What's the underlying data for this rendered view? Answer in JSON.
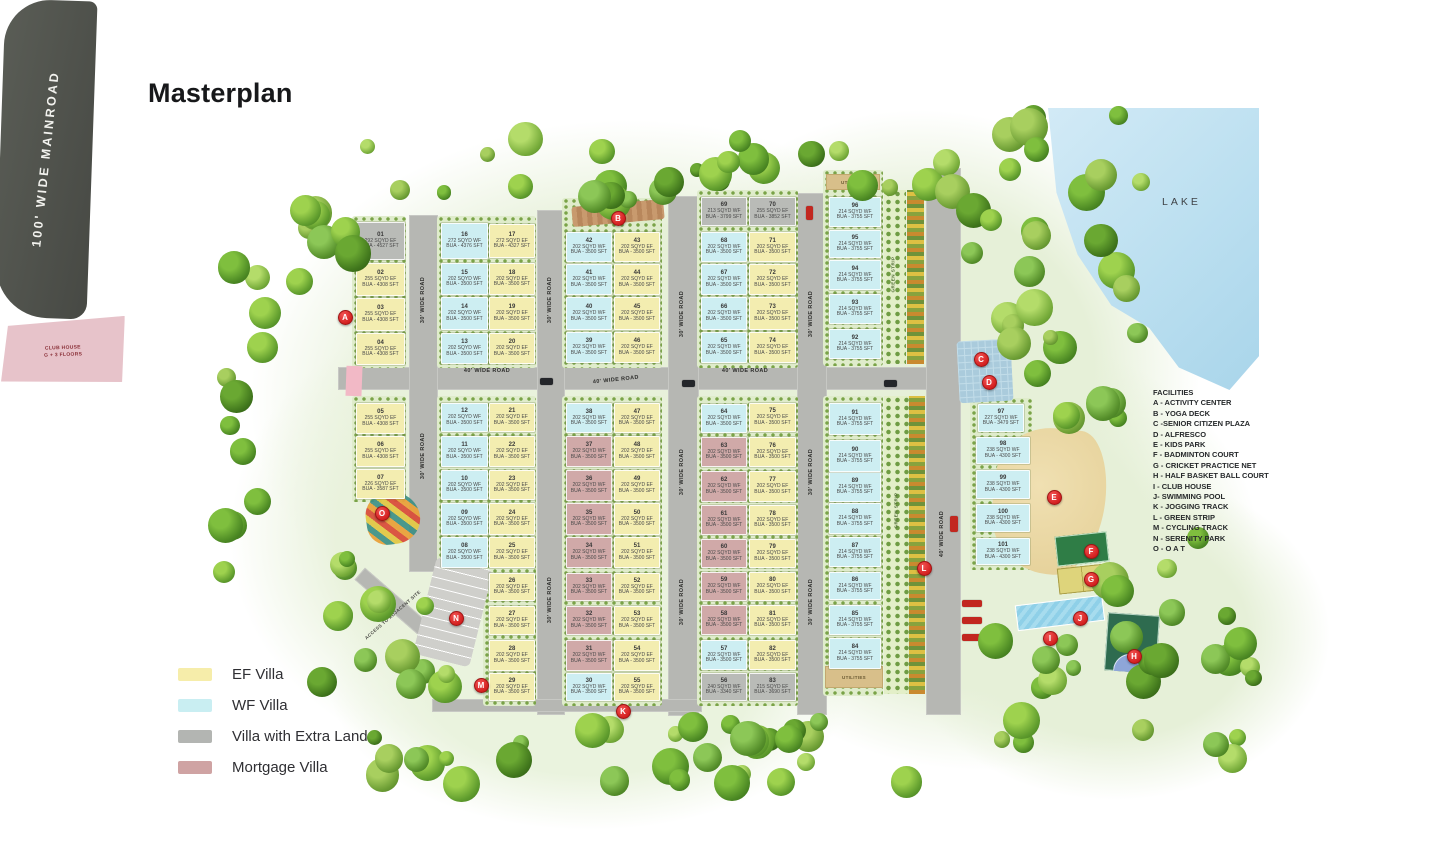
{
  "page": {
    "title": "Masterplan"
  },
  "legend": {
    "items": [
      {
        "label": "EF Villa",
        "color": "#f6edaa"
      },
      {
        "label": "WF Villa",
        "color": "#c9eef2"
      },
      {
        "label": "Villa with Extra Land",
        "color": "#b3b5b2"
      },
      {
        "label": "Mortgage Villa",
        "color": "#cfa3a3"
      }
    ]
  },
  "facilities": {
    "title": "FACILITIES",
    "items": [
      "A - ACTIVITY CENTER",
      "B - YOGA DECK",
      "C -SENIOR CITIZEN PLAZA",
      "D - ALFRESCO",
      "E - KIDS PARK",
      "F - BADMINTON COURT",
      "G - CRICKET PRACTICE NET",
      "H - HALF BASKET BALL COURT",
      "I - CLUB HOUSE",
      "J- SWIMMING POOL",
      "K - JOGGING TRACK",
      "L - GREEN STRIP",
      "M - CYCLING TRACK",
      "N - SERENITY PARK",
      "O - O A T"
    ]
  },
  "map": {
    "lake_label": "LAKE",
    "mainroad_label": "100' WIDE MAINROAD",
    "access_label": "ACCESS TO ADJACENT SITE",
    "utilities_label": "UTILITIES",
    "green_strip_label": "GREEN STRIP",
    "clubhouse": {
      "line1": "CLUB HOUSE",
      "line2": "G + 3 FLOORS"
    },
    "formats": {
      "spec": "{sq} SQYD {f}",
      "bua": "BUA - {bua} SFT"
    },
    "road_labels": [
      {
        "text": "40' WIDE ROAD",
        "x": 452,
        "y": 368,
        "r": 0
      },
      {
        "text": "40' WIDE ROAD",
        "x": 581,
        "y": 377,
        "r": -6
      },
      {
        "text": "40' WIDE ROAD",
        "x": 710,
        "y": 368,
        "r": 0
      },
      {
        "text": "40' WIDE ROAD",
        "x": 908,
        "y": 530,
        "r": -90
      },
      {
        "text": "30' WIDE ROAD",
        "x": 389,
        "y": 296,
        "r": -90
      },
      {
        "text": "30' WIDE ROAD",
        "x": 389,
        "y": 452,
        "r": -90
      },
      {
        "text": "30' WIDE ROAD",
        "x": 516,
        "y": 296,
        "r": -90
      },
      {
        "text": "30' WIDE ROAD",
        "x": 516,
        "y": 596,
        "r": -90
      },
      {
        "text": "30' WIDE ROAD",
        "x": 648,
        "y": 310,
        "r": -90
      },
      {
        "text": "30' WIDE ROAD",
        "x": 648,
        "y": 468,
        "r": -90
      },
      {
        "text": "30' WIDE ROAD",
        "x": 648,
        "y": 598,
        "r": -90
      },
      {
        "text": "30' WIDE ROAD",
        "x": 777,
        "y": 310,
        "r": -90
      },
      {
        "text": "30' WIDE ROAD",
        "x": 777,
        "y": 468,
        "r": -90
      },
      {
        "text": "30' WIDE ROAD",
        "x": 777,
        "y": 598,
        "r": -90
      }
    ],
    "markers": [
      {
        "k": "A",
        "x": 344,
        "y": 316
      },
      {
        "k": "B",
        "x": 617,
        "y": 217
      },
      {
        "k": "C",
        "x": 980,
        "y": 358
      },
      {
        "k": "D",
        "x": 988,
        "y": 381
      },
      {
        "k": "E",
        "x": 1053,
        "y": 496
      },
      {
        "k": "F",
        "x": 1090,
        "y": 550
      },
      {
        "k": "G",
        "x": 1090,
        "y": 578
      },
      {
        "k": "H",
        "x": 1133,
        "y": 655
      },
      {
        "k": "I",
        "x": 1049,
        "y": 637
      },
      {
        "k": "J",
        "x": 1079,
        "y": 617
      },
      {
        "k": "K",
        "x": 622,
        "y": 710
      },
      {
        "k": "L",
        "x": 923,
        "y": 567
      },
      {
        "k": "M",
        "x": 480,
        "y": 684
      },
      {
        "k": "N",
        "x": 455,
        "y": 617
      },
      {
        "k": "O",
        "x": 381,
        "y": 512
      }
    ],
    "plot_fields": [
      "number",
      "facing",
      "sqyd",
      "bua_sft",
      "type",
      "x",
      "y",
      "w",
      "h"
    ],
    "plots": [
      [
        "01",
        "EF",
        "292",
        "4527",
        "xl",
        356,
        222,
        47,
        36
      ],
      [
        "02",
        "EF",
        "255",
        "4308",
        "ef",
        356,
        263,
        47,
        31
      ],
      [
        "03",
        "EF",
        "255",
        "4308",
        "ef",
        356,
        298,
        47,
        31
      ],
      [
        "04",
        "EF",
        "255",
        "4308",
        "ef",
        356,
        333,
        47,
        30
      ],
      [
        "05",
        "EF",
        "255",
        "4308",
        "ef",
        356,
        403,
        47,
        29
      ],
      [
        "06",
        "EF",
        "255",
        "4308",
        "ef",
        356,
        436,
        47,
        29
      ],
      [
        "07",
        "EF",
        "226",
        "3587",
        "ef",
        356,
        469,
        47,
        28
      ],
      [
        "08",
        "WF",
        "202",
        "3500",
        "wf",
        441,
        537,
        45,
        29
      ],
      [
        "09",
        "WF",
        "202",
        "3500",
        "wf",
        441,
        503,
        45,
        30
      ],
      [
        "10",
        "WF",
        "202",
        "3500",
        "wf",
        441,
        470,
        45,
        28
      ],
      [
        "11",
        "WF",
        "202",
        "3500",
        "wf",
        441,
        436,
        45,
        29
      ],
      [
        "12",
        "WF",
        "202",
        "3500",
        "wf",
        441,
        403,
        45,
        27
      ],
      [
        "13",
        "WF",
        "202",
        "3500",
        "wf",
        441,
        333,
        45,
        29
      ],
      [
        "14",
        "WF",
        "202",
        "3500",
        "wf",
        441,
        297,
        45,
        31
      ],
      [
        "15",
        "WF",
        "202",
        "3500",
        "wf",
        441,
        263,
        45,
        30
      ],
      [
        "16",
        "WF",
        "272",
        "4376",
        "wf",
        441,
        223,
        45,
        34
      ],
      [
        "17",
        "EF",
        "272",
        "4327",
        "ef",
        489,
        224,
        44,
        32
      ],
      [
        "18",
        "EF",
        "202",
        "3500",
        "ef",
        489,
        263,
        44,
        30
      ],
      [
        "19",
        "EF",
        "202",
        "3500",
        "ef",
        489,
        297,
        44,
        31
      ],
      [
        "20",
        "EF",
        "202",
        "3500",
        "ef",
        489,
        333,
        44,
        29
      ],
      [
        "21",
        "EF",
        "202",
        "3500",
        "ef",
        489,
        403,
        44,
        27
      ],
      [
        "22",
        "EF",
        "202",
        "3500",
        "ef",
        489,
        436,
        44,
        29
      ],
      [
        "23",
        "EF",
        "202",
        "3500",
        "ef",
        489,
        470,
        44,
        28
      ],
      [
        "24",
        "EF",
        "202",
        "3500",
        "ef",
        489,
        503,
        44,
        30
      ],
      [
        "25",
        "EF",
        "202",
        "3500",
        "ef",
        489,
        537,
        44,
        29
      ],
      [
        "26",
        "EF",
        "202",
        "3500",
        "ef",
        489,
        573,
        44,
        26
      ],
      [
        "27",
        "EF",
        "202",
        "3500",
        "ef",
        489,
        606,
        44,
        27
      ],
      [
        "28",
        "EF",
        "202",
        "3500",
        "ef",
        489,
        640,
        44,
        29
      ],
      [
        "29",
        "EF",
        "202",
        "3500",
        "ef",
        489,
        673,
        44,
        26
      ],
      [
        "30",
        "WF",
        "202",
        "3500",
        "wf",
        566,
        673,
        44,
        26
      ],
      [
        "31",
        "WF",
        "202",
        "3500",
        "mg",
        566,
        640,
        44,
        29
      ],
      [
        "32",
        "WF",
        "202",
        "3500",
        "mg",
        566,
        606,
        44,
        27
      ],
      [
        "33",
        "WF",
        "202",
        "3500",
        "mg",
        566,
        573,
        44,
        26
      ],
      [
        "34",
        "WF",
        "202",
        "3500",
        "mg",
        566,
        537,
        44,
        29
      ],
      [
        "35",
        "WF",
        "202",
        "3500",
        "mg",
        566,
        503,
        44,
        30
      ],
      [
        "36",
        "WF",
        "202",
        "3500",
        "mg",
        566,
        470,
        44,
        29
      ],
      [
        "37",
        "WF",
        "202",
        "3500",
        "mg",
        566,
        436,
        44,
        29
      ],
      [
        "38",
        "WF",
        "202",
        "3500",
        "wf",
        566,
        403,
        44,
        28
      ],
      [
        "39",
        "WF",
        "202",
        "3500",
        "wf",
        566,
        332,
        44,
        29
      ],
      [
        "40",
        "WF",
        "202",
        "3500",
        "wf",
        566,
        297,
        44,
        31
      ],
      [
        "41",
        "WF",
        "202",
        "3500",
        "wf",
        566,
        264,
        44,
        29
      ],
      [
        "42",
        "WF",
        "202",
        "3500",
        "wf",
        566,
        232,
        44,
        28
      ],
      [
        "43",
        "EF",
        "202",
        "3500",
        "ef",
        614,
        232,
        44,
        28
      ],
      [
        "44",
        "EF",
        "202",
        "3500",
        "ef",
        614,
        264,
        44,
        29
      ],
      [
        "45",
        "EF",
        "202",
        "3500",
        "ef",
        614,
        297,
        44,
        31
      ],
      [
        "46",
        "EF",
        "202",
        "3500",
        "ef",
        614,
        332,
        44,
        29
      ],
      [
        "47",
        "EF",
        "202",
        "3500",
        "ef",
        614,
        403,
        44,
        28
      ],
      [
        "48",
        "EF",
        "202",
        "3500",
        "ef",
        614,
        436,
        44,
        29
      ],
      [
        "49",
        "EF",
        "202",
        "3500",
        "ef",
        614,
        470,
        44,
        29
      ],
      [
        "50",
        "EF",
        "202",
        "3500",
        "ef",
        614,
        503,
        44,
        30
      ],
      [
        "51",
        "EF",
        "202",
        "3500",
        "ef",
        614,
        537,
        44,
        29
      ],
      [
        "52",
        "EF",
        "202",
        "3500",
        "ef",
        614,
        573,
        44,
        26
      ],
      [
        "53",
        "EF",
        "202",
        "3500",
        "ef",
        614,
        606,
        44,
        27
      ],
      [
        "54",
        "EF",
        "202",
        "3500",
        "ef",
        614,
        640,
        44,
        29
      ],
      [
        "55",
        "EF",
        "202",
        "3500",
        "ef",
        614,
        673,
        44,
        26
      ],
      [
        "56",
        "WF",
        "240",
        "3340",
        "xl",
        701,
        673,
        44,
        26
      ],
      [
        "57",
        "WF",
        "202",
        "3500",
        "wf",
        701,
        640,
        44,
        28
      ],
      [
        "58",
        "WF",
        "202",
        "3500",
        "mg",
        701,
        605,
        44,
        28
      ],
      [
        "59",
        "WF",
        "202",
        "3500",
        "mg",
        701,
        572,
        44,
        27
      ],
      [
        "60",
        "WF",
        "202",
        "3500",
        "mg",
        701,
        539,
        44,
        27
      ],
      [
        "61",
        "WF",
        "202",
        "3500",
        "mg",
        701,
        505,
        44,
        28
      ],
      [
        "62",
        "WF",
        "202",
        "3500",
        "mg",
        701,
        471,
        44,
        29
      ],
      [
        "63",
        "WF",
        "202",
        "3500",
        "mg",
        701,
        437,
        44,
        28
      ],
      [
        "64",
        "WF",
        "202",
        "3500",
        "wf",
        701,
        404,
        44,
        27
      ],
      [
        "65",
        "WF",
        "202",
        "3500",
        "wf",
        701,
        332,
        44,
        29
      ],
      [
        "66",
        "WF",
        "202",
        "3500",
        "wf",
        701,
        297,
        44,
        31
      ],
      [
        "67",
        "WF",
        "202",
        "3500",
        "wf",
        701,
        264,
        44,
        29
      ],
      [
        "68",
        "WF",
        "202",
        "3500",
        "wf",
        701,
        232,
        44,
        28
      ],
      [
        "69",
        "WF",
        "213",
        "3799",
        "xl",
        701,
        197,
        44,
        27
      ],
      [
        "70",
        "EF",
        "255",
        "3852",
        "xl",
        749,
        197,
        45,
        27
      ],
      [
        "71",
        "EF",
        "202",
        "3500",
        "ef",
        749,
        232,
        45,
        28
      ],
      [
        "72",
        "EF",
        "202",
        "3500",
        "ef",
        749,
        264,
        45,
        29
      ],
      [
        "73",
        "EF",
        "202",
        "3500",
        "ef",
        749,
        297,
        45,
        31
      ],
      [
        "74",
        "EF",
        "202",
        "3500",
        "ef",
        749,
        332,
        45,
        29
      ],
      [
        "75",
        "EF",
        "202",
        "3500",
        "ef",
        749,
        403,
        45,
        27
      ],
      [
        "76",
        "EF",
        "202",
        "3500",
        "ef",
        749,
        437,
        45,
        28
      ],
      [
        "77",
        "EF",
        "202",
        "3500",
        "ef",
        749,
        471,
        45,
        29
      ],
      [
        "78",
        "EF",
        "202",
        "3500",
        "ef",
        749,
        505,
        45,
        28
      ],
      [
        "79",
        "EF",
        "202",
        "3500",
        "ef",
        749,
        539,
        45,
        27
      ],
      [
        "80",
        "EF",
        "202",
        "3500",
        "ef",
        749,
        572,
        45,
        27
      ],
      [
        "81",
        "EF",
        "202",
        "3500",
        "ef",
        749,
        605,
        45,
        28
      ],
      [
        "82",
        "EF",
        "202",
        "3500",
        "ef",
        749,
        640,
        45,
        28
      ],
      [
        "83",
        "EF",
        "215",
        "3690",
        "xl",
        749,
        673,
        45,
        26
      ],
      [
        "84",
        "WF",
        "214",
        "3755",
        "wf",
        829,
        638,
        50,
        29
      ],
      [
        "85",
        "WF",
        "214",
        "3755",
        "wf",
        829,
        605,
        50,
        28
      ],
      [
        "86",
        "WF",
        "214",
        "3755",
        "wf",
        829,
        572,
        50,
        26
      ],
      [
        "87",
        "WF",
        "214",
        "3755",
        "wf",
        829,
        537,
        50,
        28
      ],
      [
        "88",
        "WF",
        "214",
        "3755",
        "wf",
        829,
        503,
        50,
        29
      ],
      [
        "89",
        "WF",
        "214",
        "3755",
        "wf",
        829,
        472,
        50,
        28
      ],
      [
        "90",
        "WF",
        "214",
        "3755",
        "wf",
        829,
        440,
        50,
        30
      ],
      [
        "91",
        "WF",
        "214",
        "3755",
        "wf",
        829,
        403,
        50,
        30
      ],
      [
        "92",
        "WF",
        "214",
        "3755",
        "wf",
        829,
        329,
        50,
        28
      ],
      [
        "93",
        "WF",
        "214",
        "3755",
        "wf",
        829,
        294,
        50,
        28
      ],
      [
        "94",
        "WF",
        "214",
        "3755",
        "wf",
        829,
        260,
        50,
        28
      ],
      [
        "95",
        "WF",
        "214",
        "3755",
        "wf",
        829,
        230,
        50,
        26
      ],
      [
        "96",
        "WF",
        "214",
        "3755",
        "wf",
        829,
        197,
        50,
        28
      ],
      [
        "97",
        "WF",
        "227",
        "3479",
        "wf",
        978,
        404,
        44,
        26
      ],
      [
        "98",
        "WF",
        "238",
        "4300",
        "wf",
        976,
        437,
        52,
        25
      ],
      [
        "99",
        "WF",
        "238",
        "4300",
        "wf",
        976,
        470,
        52,
        27
      ],
      [
        "100",
        "WF",
        "238",
        "4300",
        "wf",
        976,
        504,
        52,
        26
      ],
      [
        "101",
        "WF",
        "238",
        "4300",
        "wf",
        976,
        538,
        52,
        25
      ]
    ]
  }
}
